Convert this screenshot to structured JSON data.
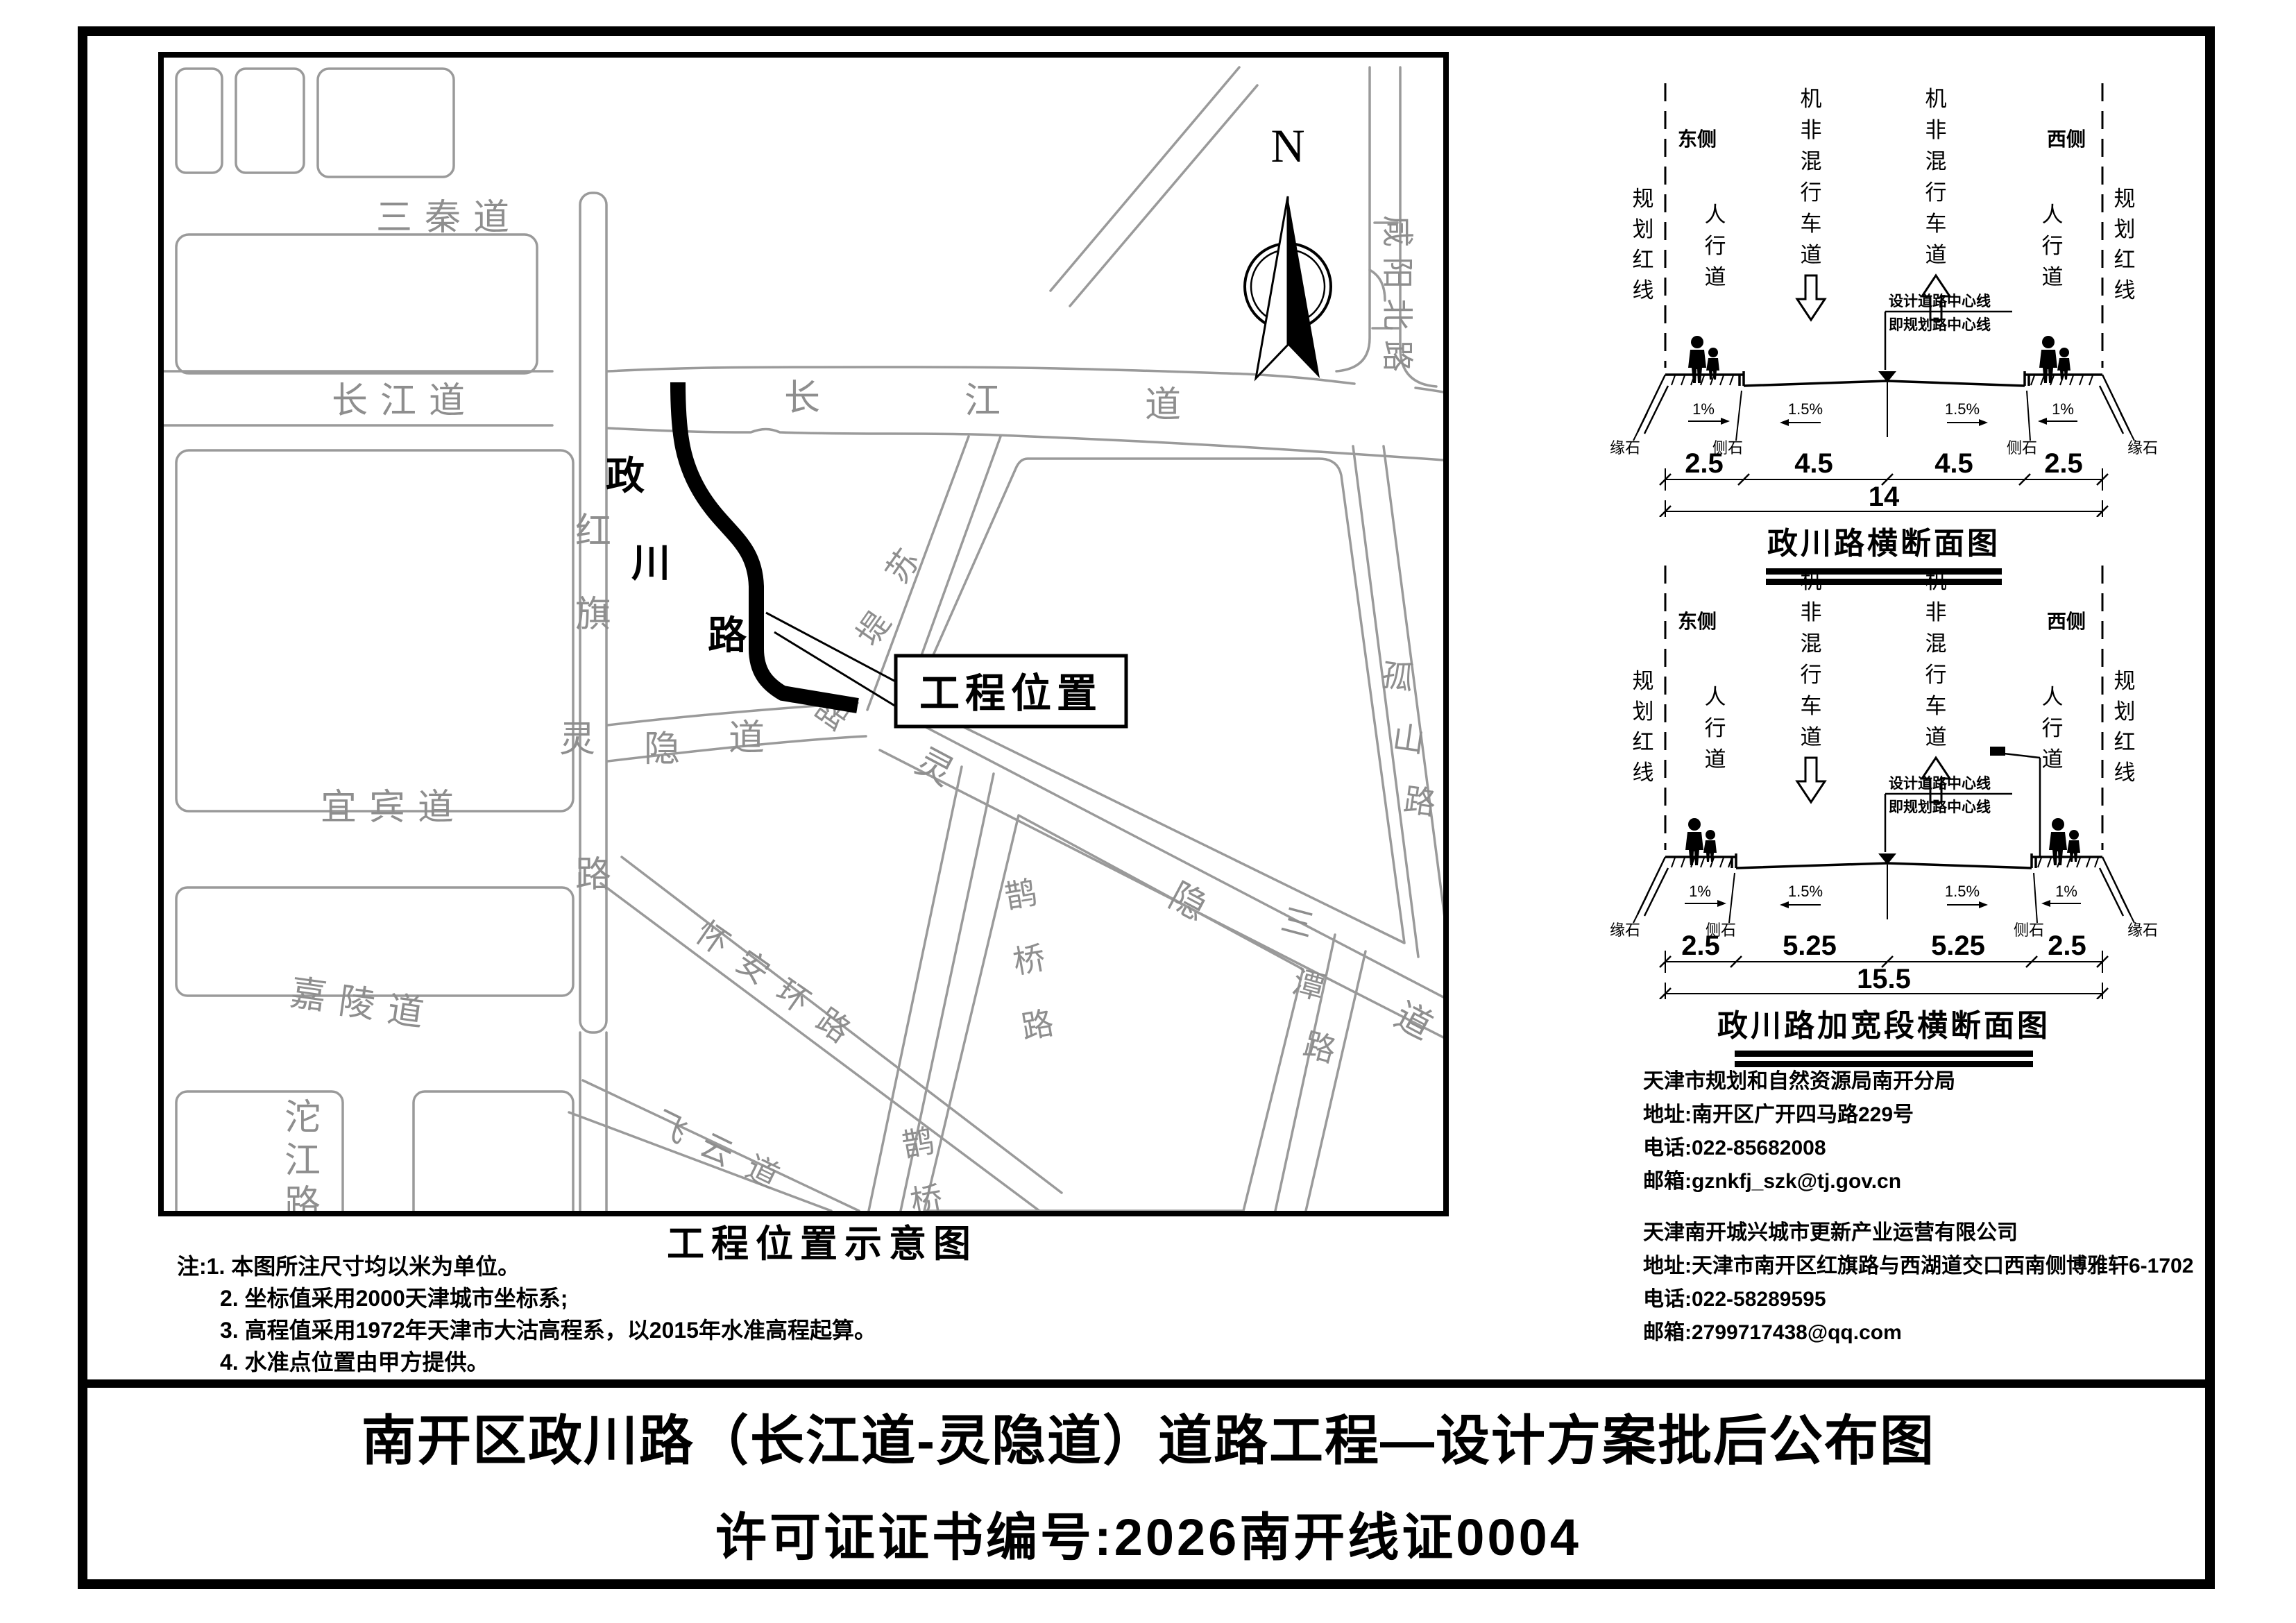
{
  "doc": {
    "title_line1": "南开区政川路（长江道-灵隐道）道路工程—设计方案批后公布图",
    "title_line2": "许可证证书编号:2026南开线证0004"
  },
  "map": {
    "caption": "工程位置示意图",
    "north_label": "N",
    "project_label": "工程位置",
    "streets": {
      "sanqin": "三秦道",
      "changjiang_w": "长江道",
      "changjiang_e": "长江道",
      "hongqi": "红旗路",
      "project": "政川路",
      "sudi": "苏堤路",
      "lingyin_w": "灵隐道",
      "lingyin_e": "灵隐道",
      "yibin": "宜宾道",
      "jialing": "嘉陵道",
      "tuojiang": "沱江路",
      "queqiao_a": "鹊桥路",
      "queqiao_b": "鹊桥路",
      "huaian": "怀安环路",
      "feiyun": "飞云道",
      "santan": "三潭路",
      "gushan": "孤山路",
      "xianyang": "咸阳北路"
    }
  },
  "notes": {
    "prefix": "注:",
    "items": [
      "1. 本图所注尺寸均以米为单位。",
      "2. 坐标值采用2000天津城市坐标系;",
      "3. 高程值采用1972年天津市大沽高程系，以2015年水准高程起算。",
      "4. 水准点位置由甲方提供。"
    ]
  },
  "sections": [
    {
      "title": "政川路横断面图",
      "side_left": "东侧",
      "side_right": "西侧",
      "red_line": "规划红线",
      "sidewalk": "人行道",
      "lane": "机非混行车道",
      "centerline_1": "设计道路中心线",
      "centerline_2": "即规划路中心线",
      "slope_walk": "1%",
      "slope_road": "1.5%",
      "curb_outer": "缘石",
      "curb_inner": "侧石",
      "dims": [
        "2.5",
        "4.5",
        "4.5",
        "2.5"
      ],
      "total": "14"
    },
    {
      "title": "政川路加宽段横断面图",
      "side_left": "东侧",
      "side_right": "西侧",
      "red_line": "规划红线",
      "sidewalk": "人行道",
      "lane": "机非混行车道",
      "centerline_1": "设计道路中心线",
      "centerline_2": "即规划路中心线",
      "slope_walk": "1%",
      "slope_road": "1.5%",
      "curb_outer": "缘石",
      "curb_inner": "侧石",
      "dims": [
        "2.5",
        "5.25",
        "5.25",
        "2.5"
      ],
      "total": "15.5"
    }
  ],
  "contacts": [
    {
      "org": "天津市规划和自然资源局南开分局",
      "address": "地址:南开区广开四马路229号",
      "phone": "电话:022-85682008",
      "email": "邮箱:gznkfj_szk@tj.gov.cn"
    },
    {
      "org": "天津南开城兴城市更新产业运营有限公司",
      "address": "地址:天津市南开区红旗路与西湖道交口西南侧博雅轩6-1702",
      "phone": "电话:022-58289595",
      "email": "邮箱:2799717438@qq.com"
    }
  ]
}
